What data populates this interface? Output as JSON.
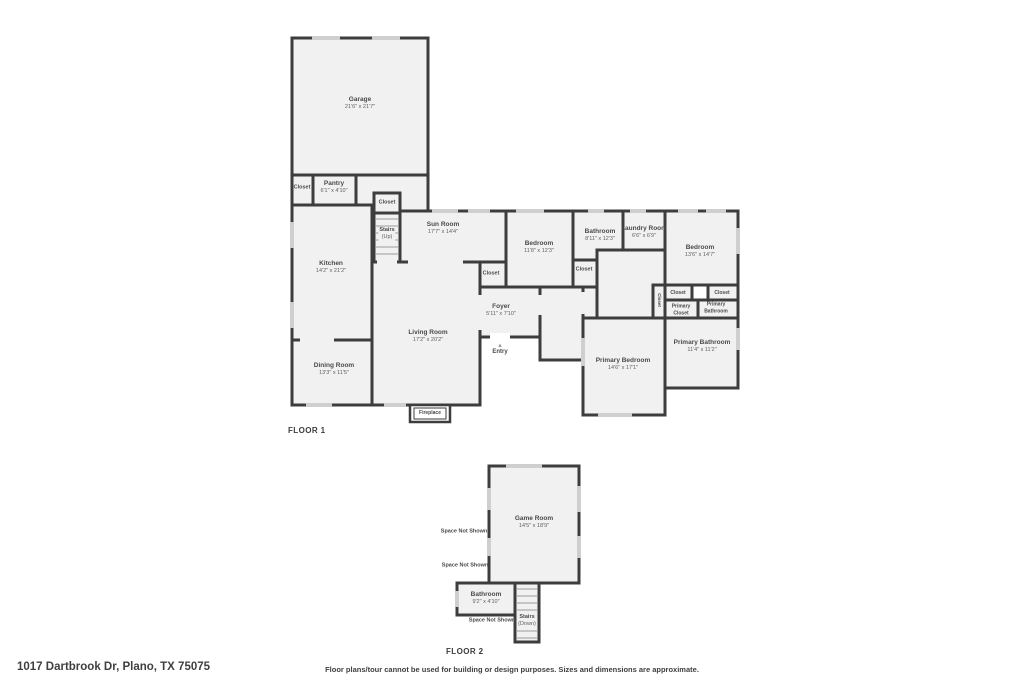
{
  "palette": {
    "wall": "#3d3d3d",
    "room_fill": "#f1f1f1",
    "label_text": "#4a4a4a",
    "dims_text": "#5f5f5f",
    "window": "#cfcfcf"
  },
  "footer": {
    "address": "1017 Dartbrook Dr, Plano, TX 75075",
    "disclaimer": "Floor plans/tour cannot be used for building or design purposes. Sizes and dimensions are approximate."
  },
  "floor1": {
    "label": "FLOOR 1",
    "entry": {
      "marker": "▲",
      "label": "Entry"
    },
    "rooms": {
      "garage": {
        "name": "Garage",
        "dims": "21'6\" x 21'7\""
      },
      "closet_a": {
        "name": "Closet"
      },
      "pantry": {
        "name": "Pantry",
        "dims": "6'1\" x 4'10\""
      },
      "stairs_closet": {
        "name": "Closet"
      },
      "stairs": {
        "name": "Stairs",
        "dims": "(Up)"
      },
      "sun_room": {
        "name": "Sun Room",
        "dims": "17'7\" x 14'4\""
      },
      "kitchen": {
        "name": "Kitchen",
        "dims": "14'2\" x 21'2\""
      },
      "sun_closet": {
        "name": "Closet"
      },
      "bedroom_mid": {
        "name": "Bedroom",
        "dims": "11'8\" x 12'3\""
      },
      "bathroom": {
        "name": "Bathroom",
        "dims": "8'11\" x 12'3\""
      },
      "laundry": {
        "name": "Laundry Room",
        "dims": "6'6\" x 6'9\""
      },
      "bedroom_right": {
        "name": "Bedroom",
        "dims": "13'6\" x 14'7\""
      },
      "bed_mid_closet": {
        "name": "Closet"
      },
      "closet_vert": {
        "name": "Closet"
      },
      "closet_b": {
        "name": "Closet"
      },
      "closet_c": {
        "name": "Closet"
      },
      "primary_closet": {
        "name": "Primary",
        "dims": "Closet"
      },
      "primary_bath_wc": {
        "name": "Primary",
        "dims": "Bathroom"
      },
      "primary_bathroom": {
        "name": "Primary Bathroom",
        "dims": "11'4\" x 11'2\""
      },
      "primary_bedroom": {
        "name": "Primary Bedroom",
        "dims": "14'6\" x 17'1\""
      },
      "foyer": {
        "name": "Foyer",
        "dims": "5'11\" x 7'10\""
      },
      "living": {
        "name": "Living Room",
        "dims": "17'2\" x 20'2\""
      },
      "dining": {
        "name": "Dining Room",
        "dims": "13'3\" x 11'5\""
      },
      "fireplace": {
        "name": "Fireplace"
      }
    }
  },
  "floor2": {
    "label": "FLOOR 2",
    "sns": [
      "Space Not Shown",
      "Space Not Shown",
      "Space Not Shown"
    ],
    "rooms": {
      "game_room": {
        "name": "Game Room",
        "dims": "14'5\" x 18'9\""
      },
      "bathroom": {
        "name": "Bathroom",
        "dims": "9'2\" x 4'10\""
      },
      "stairs": {
        "name": "Stairs",
        "dims": "(Down)"
      }
    }
  }
}
